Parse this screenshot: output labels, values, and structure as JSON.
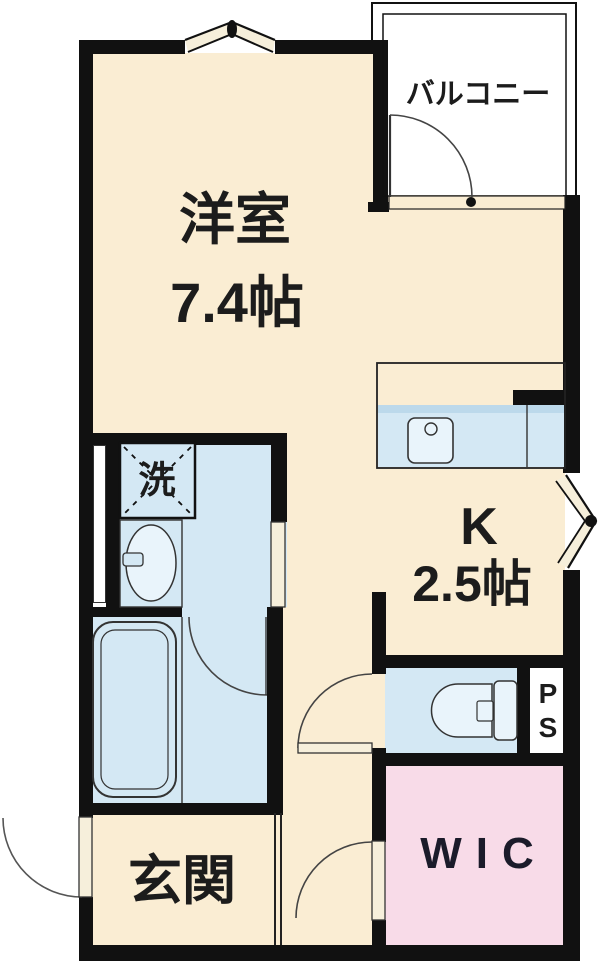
{
  "title": "floor-plan",
  "rooms": {
    "balcony": {
      "label": "バルコニー"
    },
    "living": {
      "name": "洋室",
      "size": "7.4帖"
    },
    "kitchen": {
      "name": "K",
      "size": "2.5帖"
    },
    "laundry": {
      "label": "洗"
    },
    "entrance": {
      "label": "玄関"
    },
    "wic": {
      "label": "WIC"
    },
    "ps": {
      "line1": "P",
      "line2": "S"
    }
  },
  "colors": {
    "wall": "#111111",
    "floor-cream": "#FAEDD3",
    "wet-blue": "#D4E8F4",
    "counter-edge": "#BCD9EB",
    "fixture-light": "#E9F4FB",
    "wic-pink": "#F8DBE8",
    "door-leaf": "#F6EFDB",
    "balcony-white": "#FFFFFF"
  }
}
